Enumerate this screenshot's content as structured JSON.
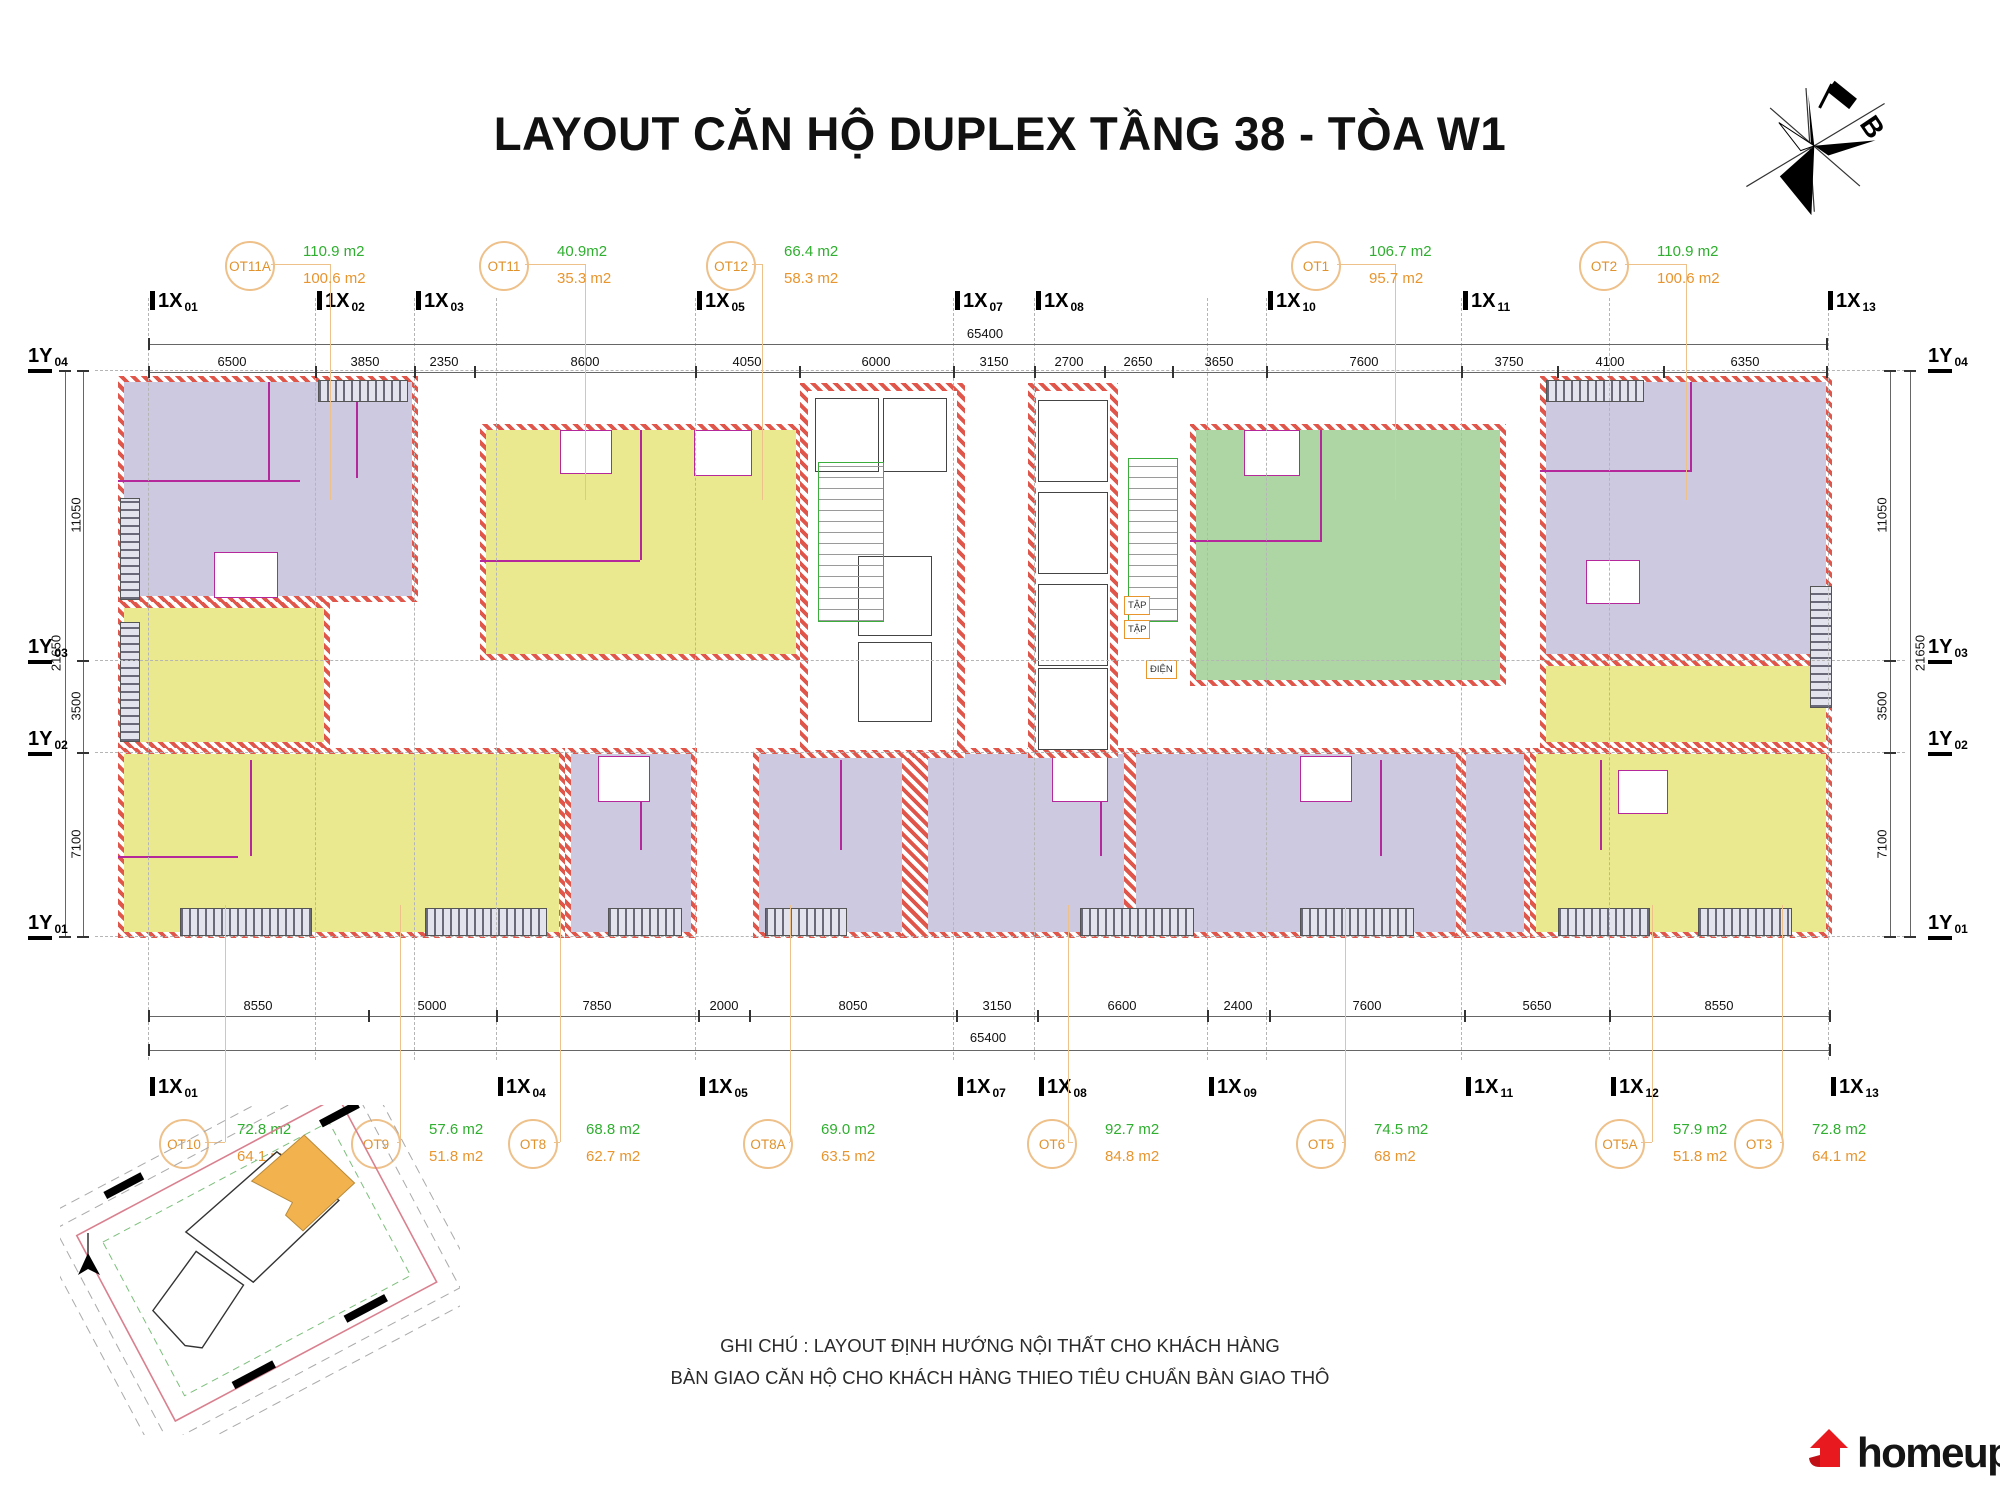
{
  "title": "LAYOUT CĂN HỘ DUPLEX TẦNG 38 - TÒA W1",
  "compass": {
    "north_label": "B"
  },
  "units": {
    "top": [
      {
        "id": "OT11A",
        "area_top": "110.9 m2",
        "area_bottom": "100.6 m2"
      },
      {
        "id": "OT11",
        "area_top": "40.9m2",
        "area_bottom": "35.3 m2"
      },
      {
        "id": "OT12",
        "area_top": "66.4 m2",
        "area_bottom": "58.3 m2"
      },
      {
        "id": "OT1",
        "area_top": "106.7 m2",
        "area_bottom": "95.7 m2"
      },
      {
        "id": "OT2",
        "area_top": "110.9 m2",
        "area_bottom": "100.6 m2"
      }
    ],
    "bottom": [
      {
        "id": "OT10",
        "area_top": "72.8 m2",
        "area_bottom": "64.1 m2"
      },
      {
        "id": "OT9",
        "area_top": "57.6 m2",
        "area_bottom": "51.8 m2"
      },
      {
        "id": "OT8",
        "area_top": "68.8 m2",
        "area_bottom": "62.7 m2"
      },
      {
        "id": "OT8A",
        "area_top": "69.0 m2",
        "area_bottom": "63.5 m2"
      },
      {
        "id": "OT6",
        "area_top": "92.7 m2",
        "area_bottom": "84.8 m2"
      },
      {
        "id": "OT5",
        "area_top": "74.5 m2",
        "area_bottom": "68 m2"
      },
      {
        "id": "OT5A",
        "area_top": "57.9 m2",
        "area_bottom": "51.8 m2"
      },
      {
        "id": "OT3",
        "area_top": "72.8 m2",
        "area_bottom": "64.1 m2"
      }
    ]
  },
  "axes": {
    "top_x": [
      {
        "p": "1X",
        "n": "01"
      },
      {
        "p": "1X",
        "n": "02"
      },
      {
        "p": "1X",
        "n": "03"
      },
      {
        "p": "1X",
        "n": "05"
      },
      {
        "p": "1X",
        "n": "07"
      },
      {
        "p": "1X",
        "n": "08"
      },
      {
        "p": "1X",
        "n": "10"
      },
      {
        "p": "1X",
        "n": "11"
      },
      {
        "p": "1X",
        "n": "13"
      }
    ],
    "bottom_x": [
      {
        "p": "1X",
        "n": "01"
      },
      {
        "p": "1X",
        "n": "04"
      },
      {
        "p": "1X",
        "n": "05"
      },
      {
        "p": "1X",
        "n": "07"
      },
      {
        "p": "1X",
        "n": "08"
      },
      {
        "p": "1X",
        "n": "09"
      },
      {
        "p": "1X",
        "n": "11"
      },
      {
        "p": "1X",
        "n": "12"
      },
      {
        "p": "1X",
        "n": "13"
      }
    ],
    "left_y": [
      {
        "p": "1Y",
        "n": "04"
      },
      {
        "p": "1Y",
        "n": "03"
      },
      {
        "p": "1Y",
        "n": "02"
      },
      {
        "p": "1Y",
        "n": "01"
      }
    ],
    "right_y": [
      {
        "p": "1Y",
        "n": "04"
      },
      {
        "p": "1Y",
        "n": "03"
      },
      {
        "p": "1Y",
        "n": "02"
      },
      {
        "p": "1Y",
        "n": "01"
      }
    ]
  },
  "dims": {
    "top_segments": [
      "6500",
      "3850",
      "2350",
      "8600",
      "4050",
      "6000",
      "3150",
      "2700",
      "2650",
      "3650",
      "7600",
      "3750",
      "4100",
      "6350"
    ],
    "top_total": "65400",
    "bottom_segments": [
      "8550",
      "5000",
      "7850",
      "2000",
      "8050",
      "3150",
      "6600",
      "2400",
      "7600",
      "5650",
      "8550"
    ],
    "bottom_total": "65400",
    "side_segments": [
      "11050",
      "3500",
      "7100"
    ],
    "side_total": "21650"
  },
  "core_labels": [
    "TẬP",
    "TẬP",
    "ĐIỆN"
  ],
  "notes": {
    "line1": "GHI CHÚ : LAYOUT  ĐỊNH HƯỚNG NỘI THẤT CHO KHÁCH HÀNG",
    "line2": "BÀN GIAO CĂN HỘ CHO KHÁCH HÀNG THIEO TIÊU CHUẨN BÀN GIAO THÔ"
  },
  "logo": {
    "text": "homeup"
  },
  "colors": {
    "unit_purple": "#cdc9e0",
    "unit_yellow": "#eae98f",
    "unit_green": "#aed6a4",
    "wall_red": "#e0564b",
    "partition_magenta": "#b5289b",
    "label_orange": "#e0922d",
    "circle_orange": "#eec08a",
    "area_green": "#2fae2f",
    "area_orange": "#e8952e",
    "logo_red": "#e8191f"
  }
}
